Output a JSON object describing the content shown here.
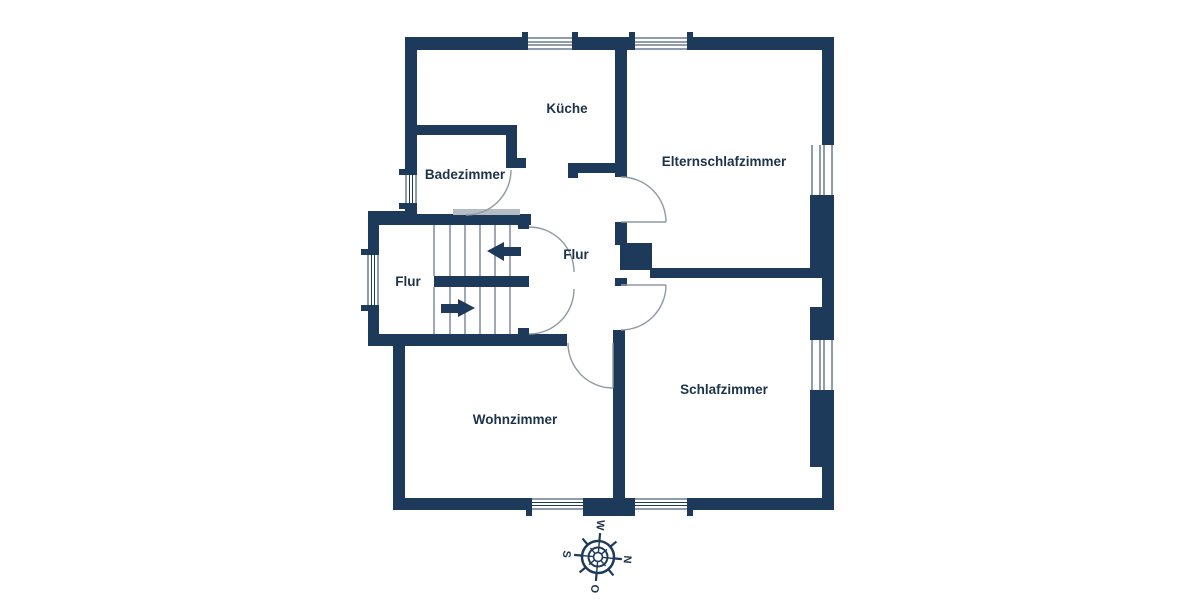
{
  "floorplan": {
    "rooms": {
      "kueche": {
        "label": "Küche"
      },
      "elternschlafzimmer": {
        "label": "Elternschlafzimmer"
      },
      "badezimmer": {
        "label": "Badezimmer"
      },
      "flur_mitte": {
        "label": "Flur"
      },
      "flur_links": {
        "label": "Flur"
      },
      "wohnzimmer": {
        "label": "Wohnzimmer"
      },
      "schlafzimmer": {
        "label": "Schlafzimmer"
      }
    },
    "compass": {
      "n": "N",
      "o": "O",
      "s": "S",
      "w": "W"
    },
    "colors": {
      "wall": "#1e3a5a",
      "label": "#1d3349",
      "background": "#ffffff",
      "door_arc": "#9099a3",
      "stair_tread": "#51627b",
      "threshold": "#b6bcc4"
    }
  }
}
